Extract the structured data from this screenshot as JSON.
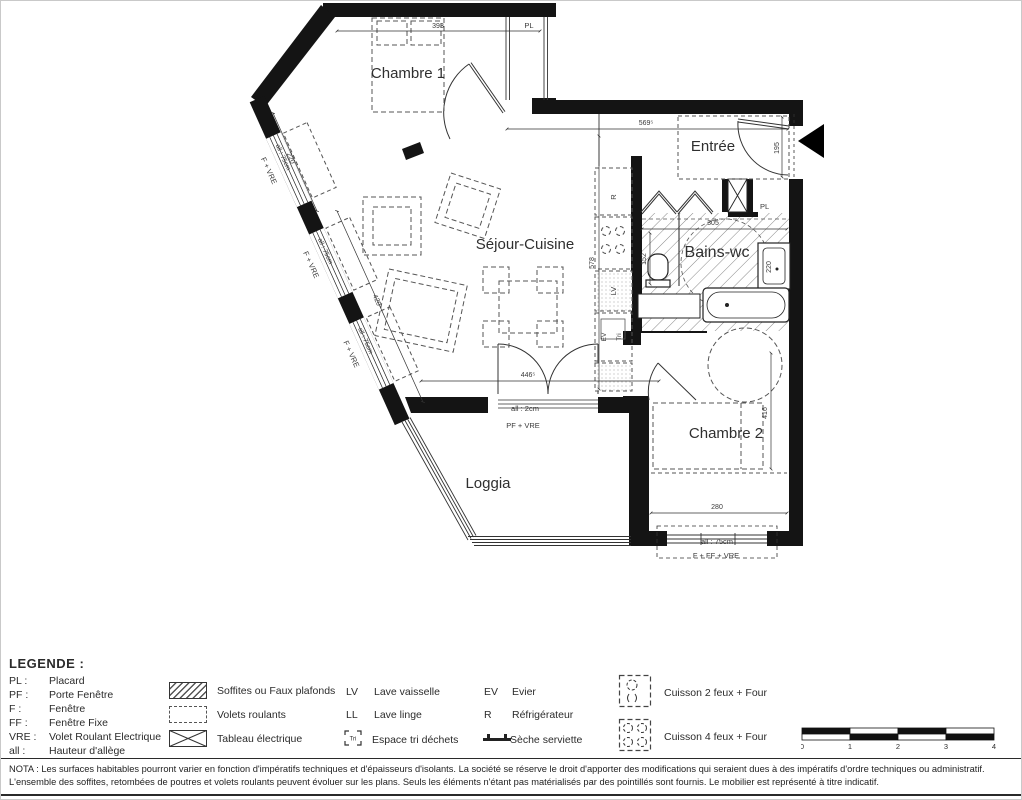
{
  "plan": {
    "rooms": {
      "chambre1": "Chambre 1",
      "entree": "Entrée",
      "sejour": "Séjour-Cuisine",
      "bains": "Bains-wc",
      "chambre2": "Chambre 2",
      "loggia": "Loggia"
    },
    "dims": {
      "d393": "393",
      "d569": "569⁵",
      "d195": "195",
      "d578": "578",
      "d420": "420",
      "d220": "220",
      "d446": "446⁵",
      "d305": "305",
      "d152": "152",
      "d220b": "220",
      "d280": "280",
      "d416": "416"
    },
    "annotations": {
      "pl": "PL",
      "window_left_label": "F + VRE",
      "window_left_all": "all : 75cm",
      "loggia_all": "all : 2cm",
      "loggia_door": "PF + VRE",
      "ch2_all": "all : 75cm",
      "ch2_window": "F + FF + VRE",
      "kitchen_r": "R",
      "kitchen_lv": "LV",
      "kitchen_ev": "EV",
      "kitchen_tri": "Tri"
    }
  },
  "legend": {
    "title": "LEGENDE :",
    "abbreviations": [
      {
        "abbr": "PL :",
        "label": "Placard"
      },
      {
        "abbr": "PF :",
        "label": "Porte Fenêtre"
      },
      {
        "abbr": "F :",
        "label": "Fenêtre"
      },
      {
        "abbr": "FF :",
        "label": "Fenêtre Fixe"
      },
      {
        "abbr": "VRE :",
        "label": "Volet Roulant Electrique"
      },
      {
        "abbr": "all :",
        "label": "Hauteur d'allège"
      }
    ],
    "ceiling_symbols": [
      {
        "label": "Soffites ou Faux plafonds"
      },
      {
        "label": "Volets roulants"
      },
      {
        "label": "Tableau électrique"
      }
    ],
    "appliance_left": [
      {
        "abbr": "LV",
        "label": "Lave vaisselle"
      },
      {
        "abbr": "LL",
        "label": "Lave linge"
      },
      {
        "abbr": "Tri",
        "label": "Espace tri déchets"
      }
    ],
    "appliance_right": [
      {
        "abbr": "EV",
        "label": "Evier"
      },
      {
        "abbr": "R",
        "label": "Réfrigérateur"
      },
      {
        "abbr": "",
        "label": "Sèche serviette"
      }
    ],
    "cuisson": [
      {
        "label": "Cuisson 2 feux + Four"
      },
      {
        "label": "Cuisson 4 feux + Four"
      }
    ],
    "scale_ticks": [
      "0",
      "1",
      "2",
      "3",
      "4"
    ]
  },
  "nota": "NOTA : Les surfaces habitables pourront varier en fonction d'impératifs techniques et d'épaisseurs d'isolants. La société se réserve le droit d'apporter des modifications qui seraient dues à des impératifs d'ordre techniques ou administratif. L'ensemble des soffites, retombées de poutres et volets roulants peuvent évoluer sur les plans. Seuls les éléments n'étant pas matérialisés par des pointillés sont fournis. Le mobilier est représenté à titre indicatif.",
  "colors": {
    "wall": "#141414",
    "text": "#2f2f2f",
    "dashed": "#555555"
  }
}
